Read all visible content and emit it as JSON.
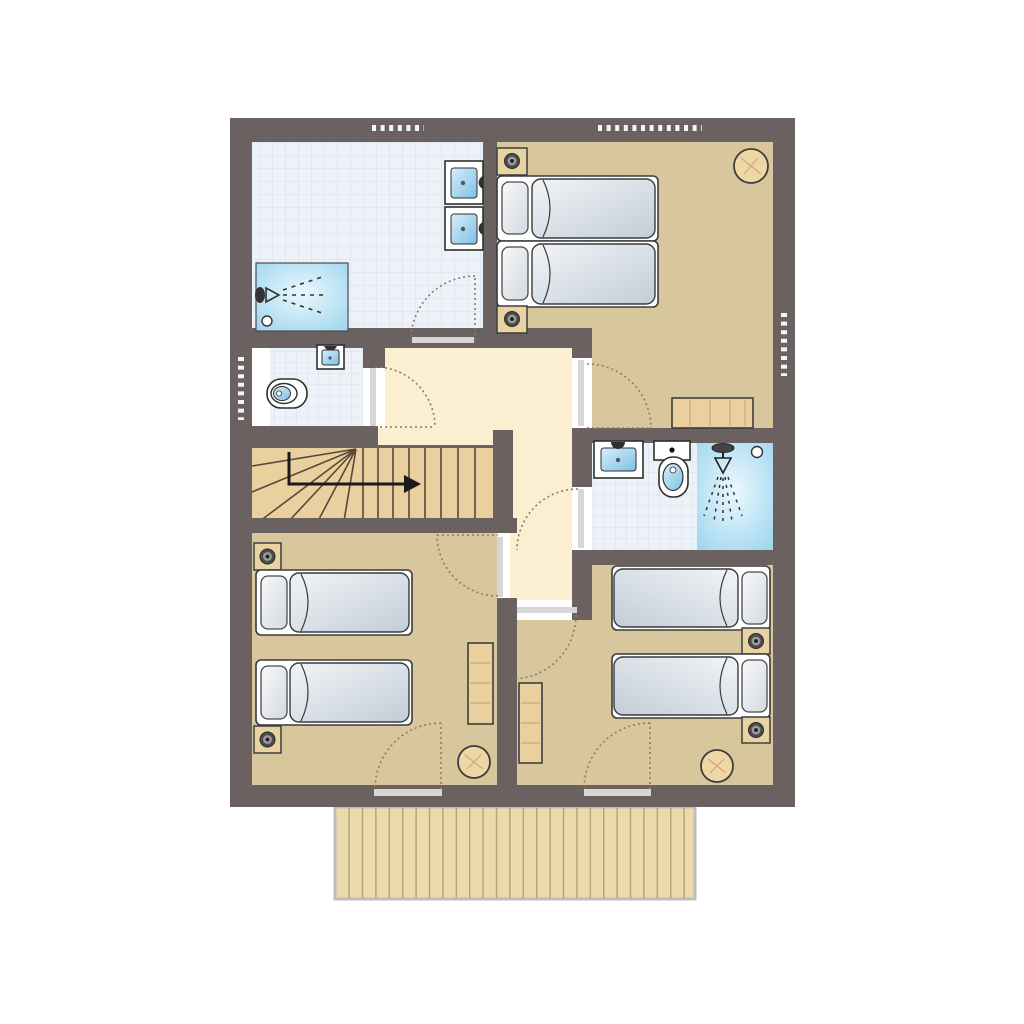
{
  "meta": {
    "type": "architectural-floor-plan",
    "description": "Upper floor plan with two bathrooms, WC, staircase, three bedrooms and a balcony"
  },
  "palette": {
    "wall": "#6a6160",
    "tan": "#d8c79c",
    "cream": "#fbeed1",
    "tile": "#edf1f8",
    "tileLine": "#d9e1ef",
    "wood": "#e9d09e",
    "woodDark": "#57493a",
    "balcony": "#ecdbaa",
    "balconyLine": "#b2a17b",
    "balconyBorder": "#bdbdbd",
    "line": "#2f2f2f",
    "threshold": "#d6d6d6",
    "arc": "#8d7b5f",
    "windowDot": "#f5f5f5",
    "grain": "#c9ab76",
    "mattressLight": "#eff2f5",
    "mattressDark": "#c2cdd7",
    "basinLight": "#c8e7f7",
    "basinDark": "#7fc0e4",
    "showerLight": "#eaf8fe",
    "showerDark": "#9cd4ee",
    "stool": "#eed7a5"
  },
  "rooms": [
    {
      "id": "bathroom-main",
      "label": "Bathroom with two washbasins and shower",
      "floor": "tiles",
      "fixtures": [
        "washbasin",
        "washbasin",
        "shower"
      ],
      "windows": 1,
      "doors": 1
    },
    {
      "id": "bedroom-double",
      "label": "Bedroom with double bed",
      "floor": "carpet",
      "furniture": [
        "double-bed",
        "nightstand",
        "nightstand",
        "round-table",
        "desk"
      ],
      "windows": 2,
      "doors": 1
    },
    {
      "id": "wc",
      "label": "Separate WC with washbasin",
      "floor": "tiles",
      "fixtures": [
        "toilet",
        "washbasin"
      ],
      "windows": 1,
      "doors": 1
    },
    {
      "id": "hallway",
      "label": "Landing hallway",
      "floor": "carpet",
      "doors": 6
    },
    {
      "id": "staircase",
      "label": "Staircase with winders, up to the right",
      "floor": "wood"
    },
    {
      "id": "bathroom-ensuite",
      "label": "Shower room with washbasin and toilet",
      "floor": "tiles",
      "fixtures": [
        "washbasin",
        "toilet",
        "shower"
      ],
      "doors": 1
    },
    {
      "id": "bedroom-twin-left",
      "label": "Twin bedroom left",
      "floor": "carpet",
      "furniture": [
        "single-bed",
        "single-bed",
        "nightstand",
        "nightstand",
        "desk",
        "stool"
      ],
      "doors": 2
    },
    {
      "id": "bedroom-twin-right",
      "label": "Twin bedroom right",
      "floor": "carpet",
      "furniture": [
        "single-bed",
        "single-bed",
        "nightstand",
        "nightstand",
        "wardrobe",
        "stool"
      ],
      "doors": 2
    },
    {
      "id": "balcony",
      "label": "Balcony with plank decking",
      "floor": "decking",
      "access_from": [
        "bedroom-twin-left",
        "bedroom-twin-right"
      ]
    }
  ],
  "counts": {
    "beds": 6,
    "washbasins": 4,
    "toilets": 2,
    "showers": 2,
    "windows": 4,
    "balcony_doors": 2,
    "interior_doors": 6
  }
}
